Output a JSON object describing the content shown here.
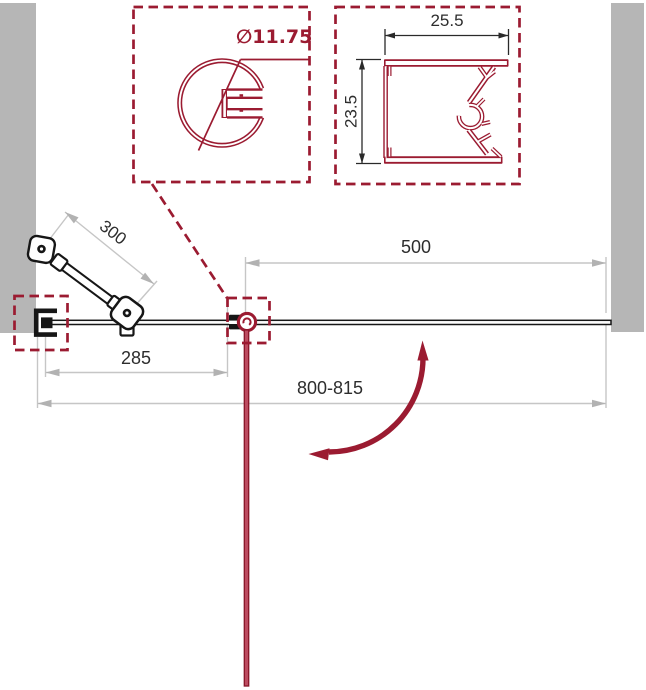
{
  "drawing": {
    "kind": "shower-door installation diagram, top view"
  },
  "detail_left": {
    "label": "∅11.75"
  },
  "detail_right": {
    "width": "25.5",
    "height": "23.5"
  },
  "dims": {
    "bar": "300",
    "opening": "500",
    "fixed": "285",
    "total": "800-815"
  },
  "icons": {
    "swing": "door-swing-arrow",
    "round_profile": "round-tube-profile",
    "wall_profile": "wall-channel-profile"
  },
  "colors": {
    "accent_crimson": "#9B1B31",
    "wall_gray": "#B6B6B6",
    "dimension_gray": "#C4C4C4",
    "ink_black": "#161616",
    "door_fill": "#BC4B60",
    "door_edge": "#871528"
  }
}
